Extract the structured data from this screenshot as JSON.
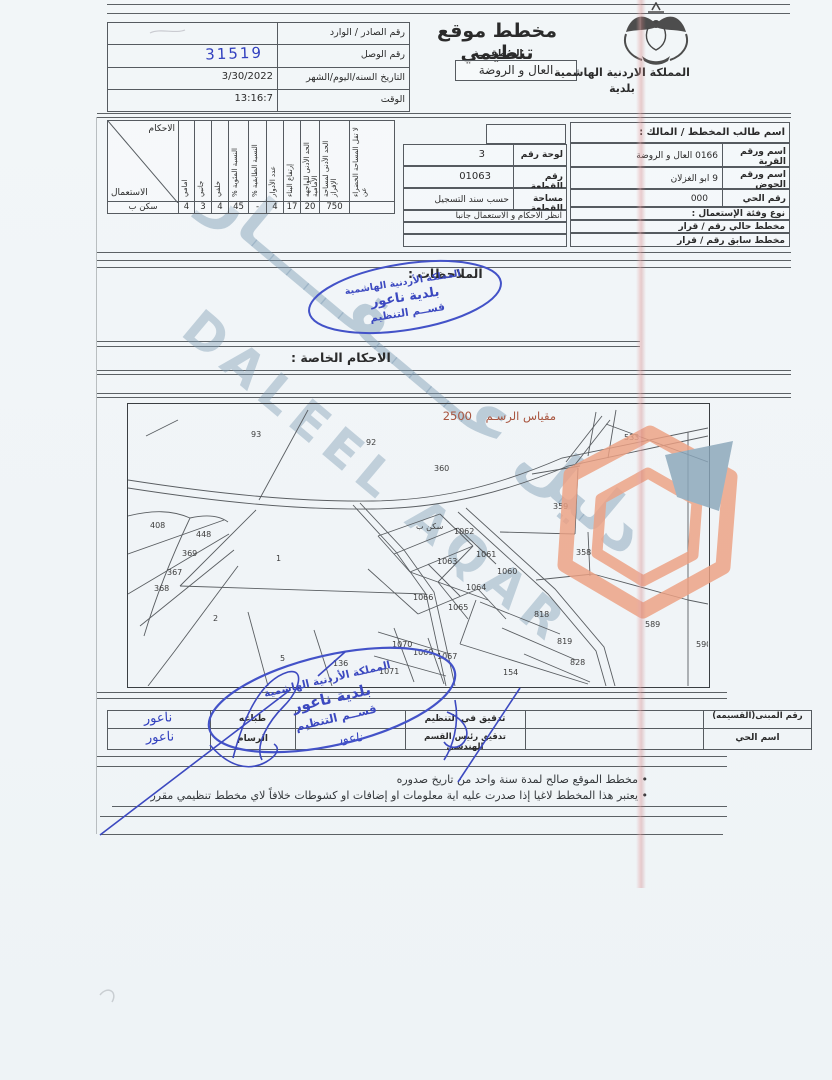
{
  "document": {
    "header": {
      "title": "مخطط موقع تنظيمي",
      "subtitle": "المنطقــــة",
      "region_box": "العال و الروضة",
      "kingdom": "المملكة الاردنية الهاشمية",
      "municipality_word": "بلدية",
      "emblem": "jordan-coat-of-arms"
    },
    "receipt_table": {
      "rows": [
        {
          "label": "رقم الصادر / الوارد",
          "value": ""
        },
        {
          "label": "رقم الوصل",
          "value": "31519"
        },
        {
          "label": "التاريخ السنه/اليوم/الشهر",
          "value": "3/30/2022"
        },
        {
          "label": "الوقت",
          "value": "13:16:7"
        }
      ]
    },
    "provisions_table": {
      "corner_top": "الاحكام",
      "corner_bottom": "الاستعمال",
      "columns": [
        "امامي",
        "جانبي",
        "خلفي",
        "النسبة المئوية %",
        "النسبة الطابقية %",
        "عدد الأدوار",
        "إرتفاع البناء",
        "الحد الأدنى للواجهه الأمامية",
        "الحد الأدنى لمساحة الإفراز",
        "لا تقل المساحة الخضراء عن"
      ],
      "row_label": "سكن ب",
      "values": [
        "4",
        "3",
        "4",
        "45",
        "-",
        "4",
        "17",
        "20",
        "750",
        ""
      ]
    },
    "plot_table": {
      "rows": [
        {
          "label": "لوحة رقم",
          "value": "3"
        },
        {
          "label": "رقم القطعة",
          "value": "01063"
        },
        {
          "label": "مساحة القطعة",
          "value": "حسب سند التسجيل"
        }
      ],
      "note": "انظر الاحكام و الاستعمال جانبا"
    },
    "owner_table": {
      "header": "اسم طالب المخطط / المالك :",
      "rows": [
        {
          "label": "اسم ورقم القرية",
          "value": "0166 العال و الروضة"
        },
        {
          "label": "اسم ورقم الحوض",
          "value": "9 ابو الغزلان"
        },
        {
          "label": "رقم الحي",
          "value": "000"
        }
      ],
      "usage_header": "نوع وفئة الإستعمال :",
      "current_plan": "مخطط حالي رقم / قرار",
      "previous_plan": "مخطط سابق رقم / قرار"
    },
    "sections": {
      "notes_label": "الملاحظات :",
      "special_provisions_label": "الاحكام الخاصة :"
    },
    "stamp": {
      "kingdom": "المملكة الأردنية الهاشمية",
      "municipality": "بلدية ناعور",
      "department": "قســم التنظيم"
    },
    "map": {
      "scale_label": "مقياس الرسـم",
      "scale_value": "2500",
      "zone_label": "سكن ب",
      "parcels": [
        {
          "n": "93",
          "x": 123,
          "y": 33
        },
        {
          "n": "92",
          "x": 238,
          "y": 41
        },
        {
          "n": "533",
          "x": 496,
          "y": 36
        },
        {
          "n": "360",
          "x": 306,
          "y": 67
        },
        {
          "n": "408",
          "x": 22,
          "y": 124
        },
        {
          "n": "448",
          "x": 68,
          "y": 133
        },
        {
          "n": "369",
          "x": 54,
          "y": 152
        },
        {
          "n": "367",
          "x": 39,
          "y": 171
        },
        {
          "n": "368",
          "x": 26,
          "y": 187
        },
        {
          "n": "1",
          "x": 148,
          "y": 157
        },
        {
          "n": "2",
          "x": 85,
          "y": 217
        },
        {
          "n": "5",
          "x": 152,
          "y": 257
        },
        {
          "n": "136",
          "x": 205,
          "y": 262
        },
        {
          "n": "1062",
          "x": 326,
          "y": 130
        },
        {
          "n": "1061",
          "x": 348,
          "y": 153
        },
        {
          "n": "1063",
          "x": 309,
          "y": 160
        },
        {
          "n": "1060",
          "x": 369,
          "y": 170
        },
        {
          "n": "1064",
          "x": 338,
          "y": 186
        },
        {
          "n": "1066",
          "x": 285,
          "y": 196
        },
        {
          "n": "1065",
          "x": 320,
          "y": 206
        },
        {
          "n": "818",
          "x": 406,
          "y": 213
        },
        {
          "n": "819",
          "x": 429,
          "y": 240
        },
        {
          "n": "828",
          "x": 442,
          "y": 261
        },
        {
          "n": "359",
          "x": 425,
          "y": 105
        },
        {
          "n": "358",
          "x": 448,
          "y": 151
        },
        {
          "n": "589",
          "x": 517,
          "y": 223
        },
        {
          "n": "590",
          "x": 568,
          "y": 243
        },
        {
          "n": "1070",
          "x": 264,
          "y": 243
        },
        {
          "n": "1069",
          "x": 285,
          "y": 251
        },
        {
          "n": "1067",
          "x": 309,
          "y": 255
        },
        {
          "n": "1071",
          "x": 251,
          "y": 270
        },
        {
          "n": "154",
          "x": 375,
          "y": 271
        }
      ]
    },
    "approval_table": {
      "col_print": {
        "top": "طباعه",
        "bottom": "الرسام"
      },
      "col_check": {
        "top": "تدقيق في التنظيم",
        "bottom": "تدقيق رئيس القسم الهندسي"
      },
      "col_right": {
        "top": "رقم المبنى(القسيمه)",
        "bottom": "اسم الحي"
      }
    },
    "handwriting": {
      "receipt_number": "31519",
      "naour1": "ناعور",
      "naour2": "ناعور",
      "naour3": "ناعور"
    },
    "footer_notes": {
      "note1": "• مخطط الموقع صالح لمدة سنة واحد من تاريخ صدوره",
      "note2": "• يعتبر هذا المخطط لاغيا إذا صدرت عليه اية معلومات او إضافات او كشوطات خلافاً لاي مخطط تنظيمي مقرر"
    },
    "watermark": {
      "arabic": "دليل عـــــقـــــار",
      "latin": "DALEEL AQAR"
    }
  }
}
